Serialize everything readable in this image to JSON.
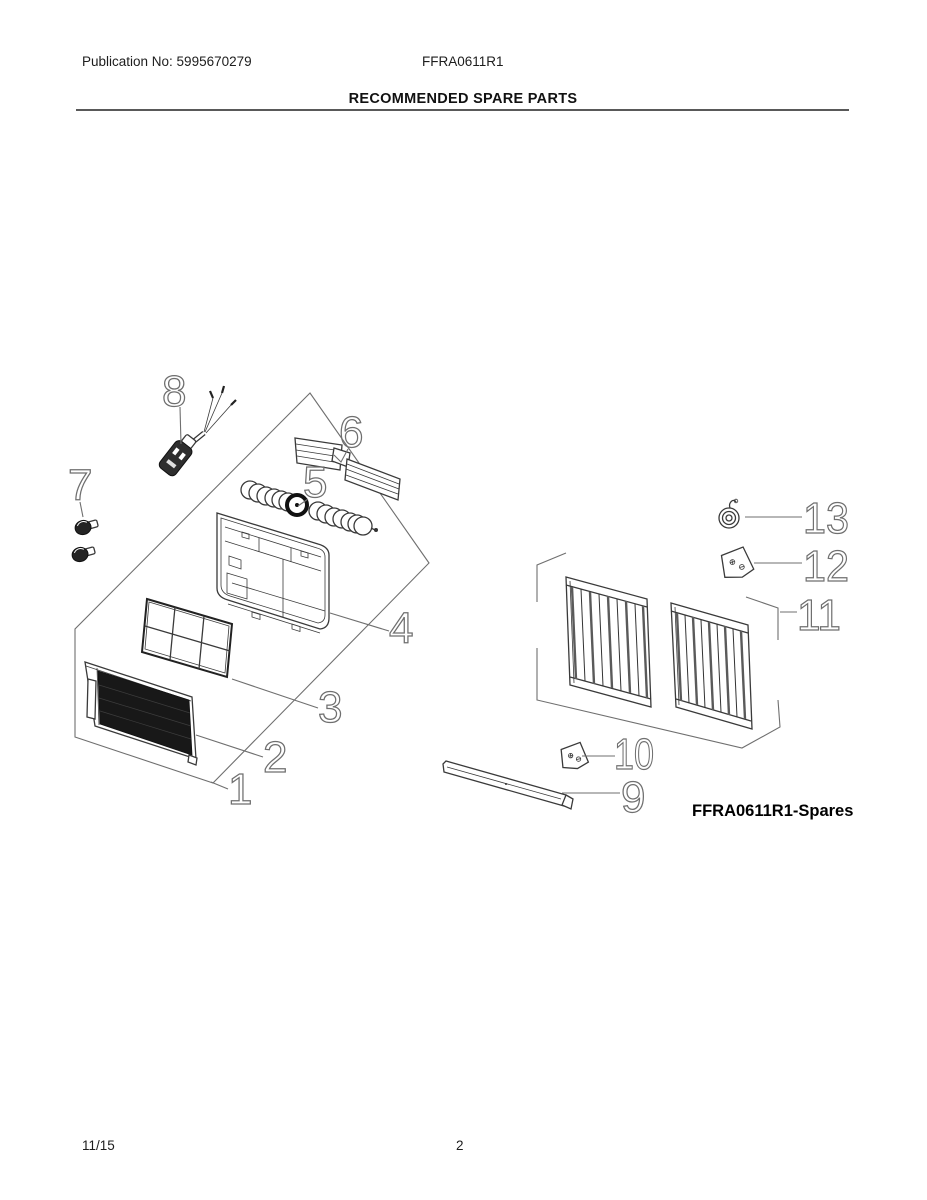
{
  "header": {
    "publication_no": "Publication No: 5995670279",
    "model": "FFRA0611R1",
    "title": "RECOMMENDED SPARE PARTS"
  },
  "diagram": {
    "spares_label": "FFRA0611R1-Spares",
    "callouts": [
      {
        "label": "1"
      },
      {
        "label": "2"
      },
      {
        "label": "3"
      },
      {
        "label": "4"
      },
      {
        "label": "5"
      },
      {
        "label": "6"
      },
      {
        "label": "7"
      },
      {
        "label": "8"
      },
      {
        "label": "9"
      },
      {
        "label": "10"
      },
      {
        "label": "11"
      },
      {
        "label": "12"
      },
      {
        "label": "13"
      }
    ]
  },
  "footer": {
    "date_code": "11/15",
    "page_number": "2"
  }
}
